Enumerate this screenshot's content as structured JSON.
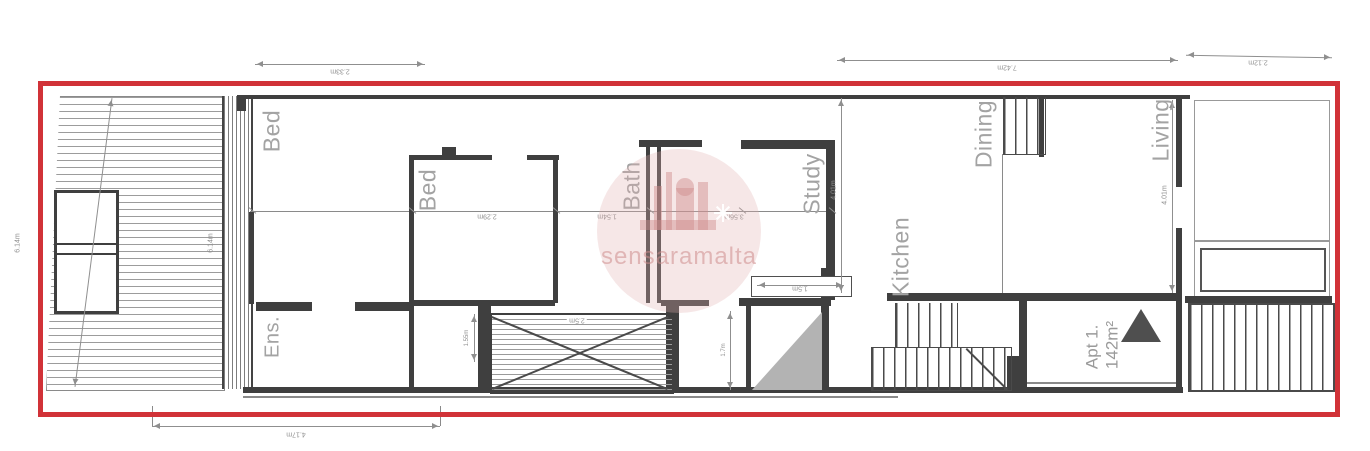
{
  "plan": {
    "title": "Apartment floor plan",
    "colors": {
      "boundary_red": "#d13238",
      "wall_gray": "#3f3f3f",
      "room_label_gray": "#a3a3a3",
      "dimension_gray": "#8f8f8f",
      "void_fill_gray": "#b3b3b3",
      "watermark_pink": "#e2b0b0"
    },
    "watermark": {
      "text": "sensaramalta"
    },
    "apartment": {
      "name": "Apt 1.",
      "area": "142m²"
    },
    "rooms": {
      "bed_terrace": "Bed",
      "ensuite": "Ens.",
      "bed2": "Bed",
      "bath": "Bath",
      "study": "Study",
      "kitchen": "Kitchen",
      "dining": "Dining",
      "living": "Living"
    },
    "dimensions": {
      "dim_top_left": "2.33m",
      "dim_top_main": "7.42m",
      "dim_top_right": "2.12m",
      "dim_left_height": "6.14m",
      "dim_terrace_height": "6.14m",
      "dim_bottom_left": "4.17m",
      "dim_bed2_width": "2.29m",
      "dim_bath_width": "1.54m",
      "dim_study_width": "3.56m",
      "dim_kitchen_depth": "4.01m",
      "dim_living_depth": "4.01m",
      "dim_hall_width": "1.5m",
      "dim_shaft_height": "1.55m",
      "dim_shaft_width": "2.5m",
      "dim_yard_height": "1.7m"
    }
  }
}
